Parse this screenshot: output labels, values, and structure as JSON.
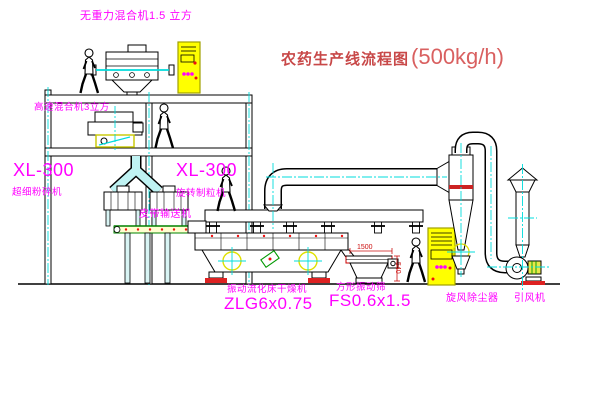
{
  "title": {
    "name": "农药生产线流程图",
    "capacity": "(500kg/h)"
  },
  "labels": {
    "gravity_mixer": "无重力混合机1.5 立方",
    "speed_mixer": "高速混合机3立方",
    "mill_model": "XL-300",
    "mill_name": "超细粉碎机",
    "granulator_model": "XL-300",
    "granulator_name": "旋转制粒机",
    "belt_conveyor": "皮带输送机",
    "dryer_name": "振动流化床干燥机",
    "dryer_model": "ZLG6x0.75",
    "sieve_name": "方形振动筛",
    "sieve_model": "FS0.6x1.5",
    "cyclone": "旋风除尘器",
    "fan": "引风机"
  },
  "dimensions": {
    "sieve_length": "1500",
    "sieve_height": "540"
  },
  "colors": {
    "label_magenta": "#ff00ff",
    "title_red": "#c84848",
    "centerline_cyan": "#00dcdc",
    "cabinet_yellow": "#ffff00",
    "dimension_red": "#cc1111",
    "conveyor_green": "#008000",
    "line_black": "#000000"
  }
}
